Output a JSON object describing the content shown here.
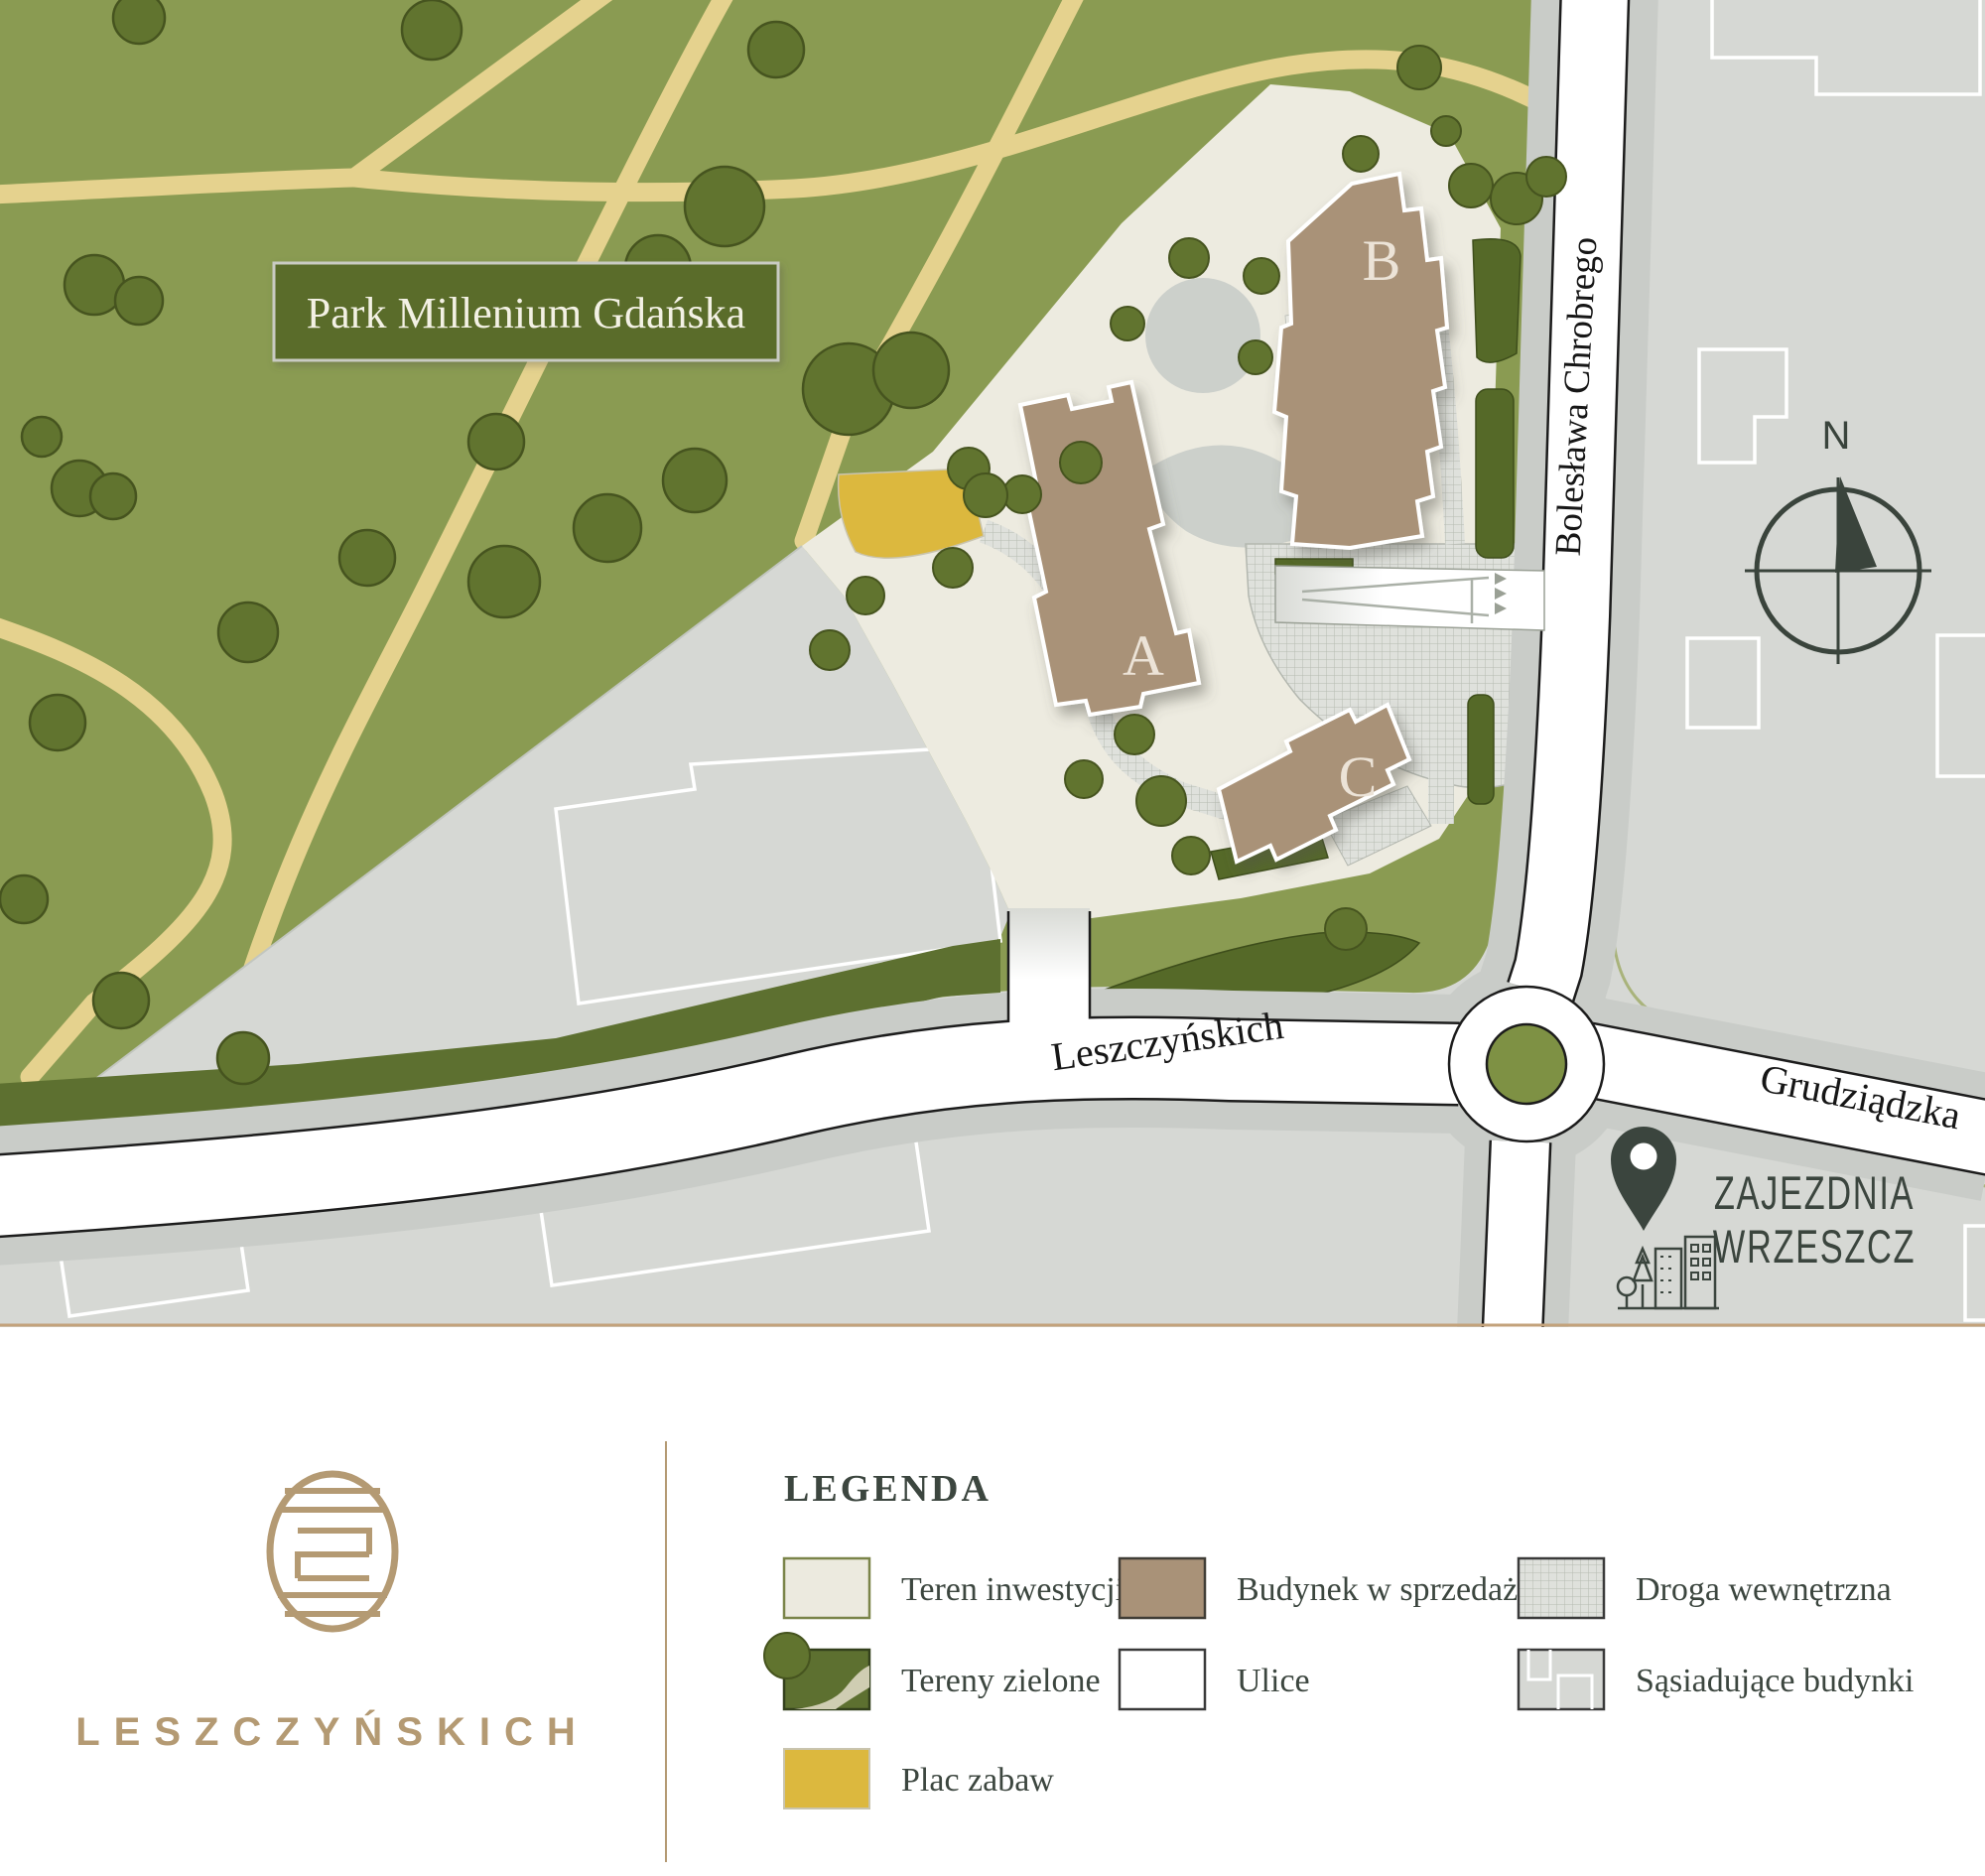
{
  "map": {
    "park_label": "Park Millenium Gdańska",
    "street_chrobrego": "Bolesława Chrobrego",
    "street_leszczynskich": "Leszczyńskich",
    "street_grudziadzka": "Grudziądzka",
    "building_a": "A",
    "building_b": "B",
    "building_c": "C",
    "compass_north": "N",
    "poi_zajezdnia_line1": "ZAJEZDNIA",
    "poi_zajezdnia_line2": "WRZESZCZ"
  },
  "legend": {
    "title": "LEGENDA",
    "items": [
      {
        "id": "investment-area",
        "label": "Teren inwestycji"
      },
      {
        "id": "building-for-sale",
        "label": "Budynek w sprzedaży"
      },
      {
        "id": "internal-road",
        "label": "Droga wewnętrzna"
      },
      {
        "id": "green-areas",
        "label": "Tereny zielone"
      },
      {
        "id": "streets",
        "label": "Ulice"
      },
      {
        "id": "neighboring-buildings",
        "label": "Sąsiadujące budynki"
      },
      {
        "id": "playground",
        "label": "Plac zabaw"
      }
    ]
  },
  "brand": {
    "name": "LESZCZYŃSKICH"
  },
  "colors": {
    "park_green": "#8a9b52",
    "dark_green": "#5d7030",
    "path_tan": "#e5d28e",
    "playground_yellow": "#dcb83e",
    "site_cream": "#edebe0",
    "building_tan": "#a99278",
    "road_white": "#ffffff",
    "road_casing": "#1c1c1c",
    "sidewalk_gray": "#c9ccc8",
    "block_gray": "#d6d8d4",
    "olive_line": "#a9b37b",
    "brand_gold": "#b49a73",
    "ink": "#3b453e"
  }
}
